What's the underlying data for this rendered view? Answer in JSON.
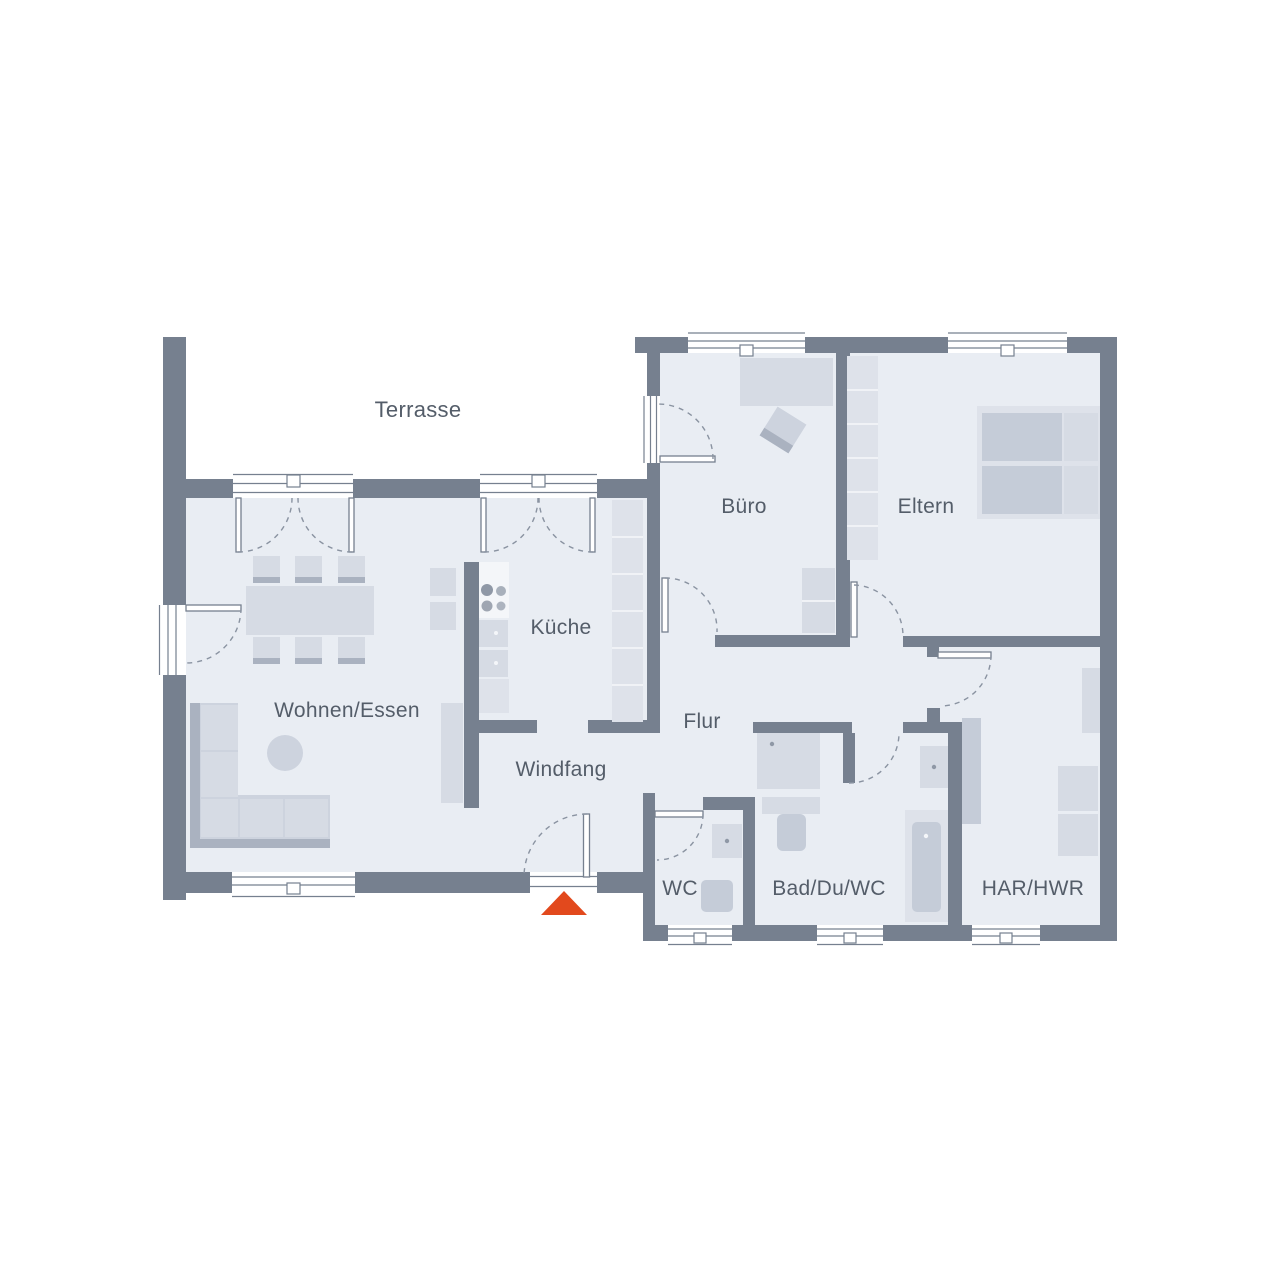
{
  "palette": {
    "wall": "#76808F",
    "floor": "#E9EDF3",
    "accent": "#E2491D",
    "label": "#545D69",
    "dash": "#8A93A1"
  },
  "rooms": {
    "terrasse": {
      "label": "Terrasse"
    },
    "buero": {
      "label": "Büro"
    },
    "eltern": {
      "label": "Eltern"
    },
    "kueche": {
      "label": "Küche"
    },
    "wohnen": {
      "label": "Wohnen/Essen"
    },
    "flur": {
      "label": "Flur"
    },
    "windfang": {
      "label": "Windfang"
    },
    "wc": {
      "label": "WC"
    },
    "bad": {
      "label": "Bad/Du/WC"
    },
    "har": {
      "label": "HAR/HWR"
    }
  },
  "entrance_marker": {
    "shape": "triangle-up",
    "color": "#E2491D"
  }
}
